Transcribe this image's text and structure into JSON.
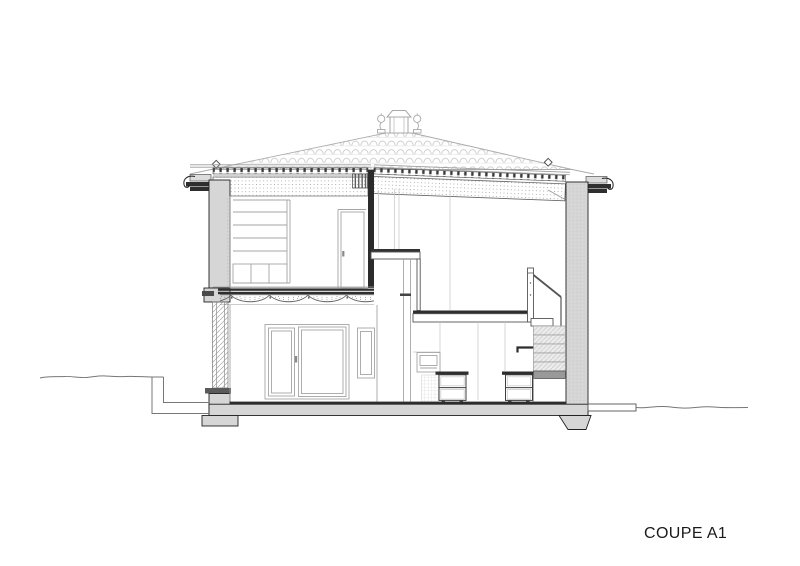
{
  "drawing": {
    "title": "COUPE A1",
    "type": "architectural-section-elevation",
    "colors": {
      "background": "#ffffff",
      "wall-fill": "#d6d6d6",
      "cut-line": "#222222",
      "dark-accent": "#2e2e2e",
      "projection-line": "#ababab",
      "interior-line": "#9a9a9a"
    },
    "parts": [
      "tiled hip roof",
      "chimney and roof finials",
      "eaves cornices with gutter hooks",
      "upper-floor room with shelving unit and door",
      "decorative frieze under floor slab",
      "ground-floor french windows",
      "open space with mezzanine slab",
      "kitchen with drawer units",
      "staircase with railing",
      "terrace step and ground lines"
    ]
  }
}
